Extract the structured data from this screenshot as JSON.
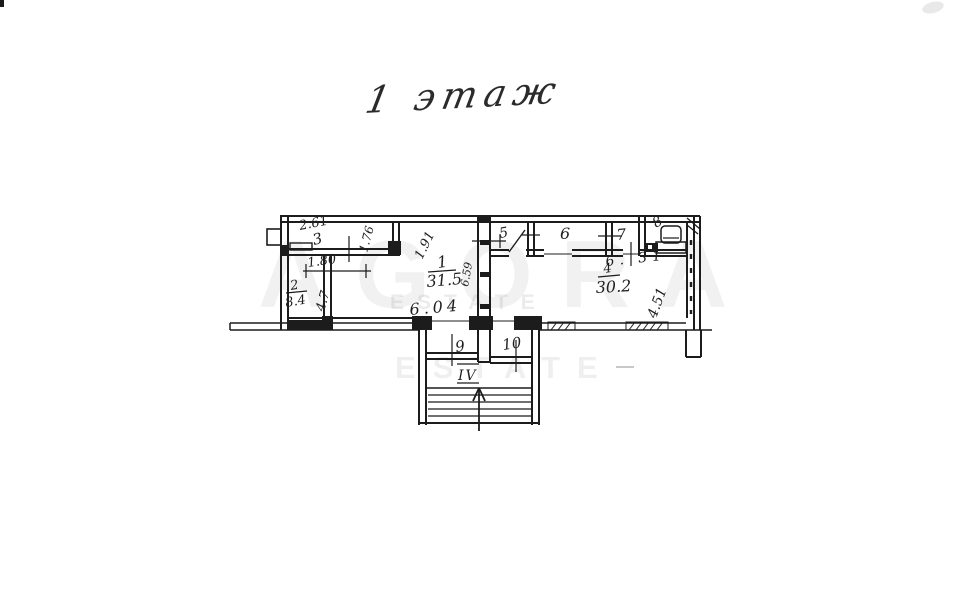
{
  "title": {
    "number": "1",
    "word": "этаж"
  },
  "watermark": {
    "brand": "AGORA",
    "estate": "ESTATE"
  },
  "plan": {
    "rooms": {
      "r1": {
        "number": "1",
        "area": "31.5"
      },
      "r2": {
        "number": "2",
        "area": "8.4"
      },
      "r3": {
        "number": "3"
      },
      "r4": {
        "number": "4",
        "area": "30.2"
      },
      "r5": {
        "number": "5"
      },
      "r6": {
        "number": "6"
      },
      "r7": {
        "number": "7"
      },
      "r8": {
        "number": "8"
      },
      "r9": {
        "number": "9"
      },
      "r10": {
        "number": "10"
      }
    },
    "stair": {
      "label": "IV"
    },
    "dims": {
      "d261": "2.61",
      "d176": "1.76",
      "d191": "1.91",
      "d180": "1.80",
      "d47": "4.7",
      "d604": "6.04",
      "d659": "6.59",
      "d631": "6. 31",
      "d451": "4.51"
    }
  }
}
